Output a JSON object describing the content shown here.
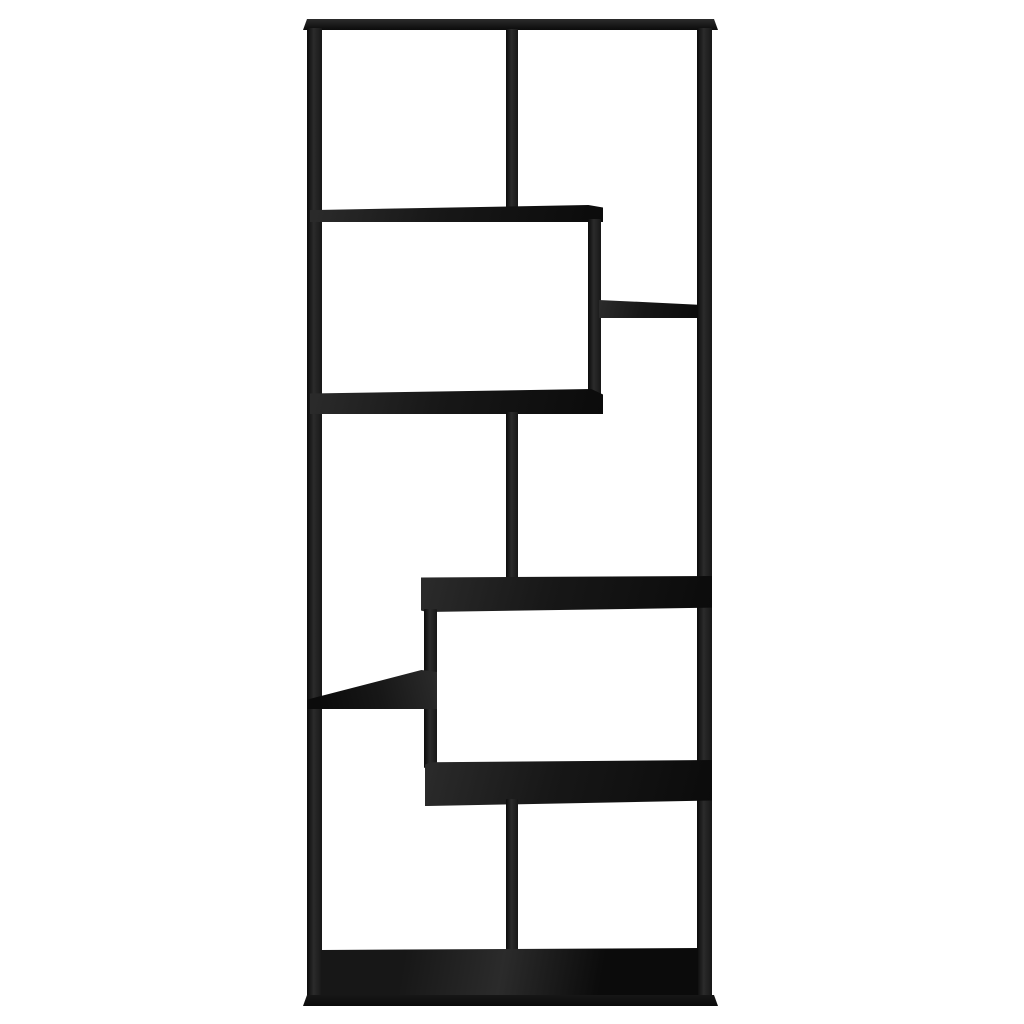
{
  "image": {
    "kind": "product-photo",
    "description": "Front view of a black geometric zigzag bookcase with 8 open compartments on a plain white background",
    "compartment_count": 8,
    "orientation": "tall vertical rectangle, centered horizontally"
  },
  "colors": {
    "background": "#ffffff",
    "wood": "#171717",
    "wood_highlight": "#2b2b2b",
    "wood_shadow": "#0b0b0b"
  },
  "parts": [
    {
      "name": "top-panel",
      "description": "full-width top rail with slightly flared ends"
    },
    {
      "name": "left-side-panel",
      "description": "full-height left upright"
    },
    {
      "name": "right-side-panel",
      "description": "full-height right upright"
    },
    {
      "name": "divider-top-center",
      "description": "vertical divider splitting the top row"
    },
    {
      "name": "shelf-row1-left",
      "description": "shelf closing the top-left compartment"
    },
    {
      "name": "divider-right-upper",
      "description": "short vertical divider hanging from shelf-row1-left"
    },
    {
      "name": "shelf-right-upper",
      "description": "small shelf in the right column"
    },
    {
      "name": "shelf-row2-left",
      "description": "wide shelf under the second-row left compartment"
    },
    {
      "name": "divider-middle-center",
      "description": "vertical divider between shelf-row2-left and the wide middle shelf"
    },
    {
      "name": "shelf-middle-wide",
      "description": "wide shelf reaching the right side panel"
    },
    {
      "name": "divider-lower-left",
      "description": "vertical divider dropping to the lower wide shelf"
    },
    {
      "name": "shelf-left-small",
      "description": "small wedge shelf attached to the left panel"
    },
    {
      "name": "shelf-lower-wide",
      "description": "wide lower shelf reaching the right side panel"
    },
    {
      "name": "divider-bottom-center",
      "description": "vertical divider splitting the bottom row"
    },
    {
      "name": "interior-floor",
      "description": "bottom interior floor seen at a slight angle"
    },
    {
      "name": "base-panel",
      "description": "full-width bottom rail with slightly flared ends"
    }
  ]
}
